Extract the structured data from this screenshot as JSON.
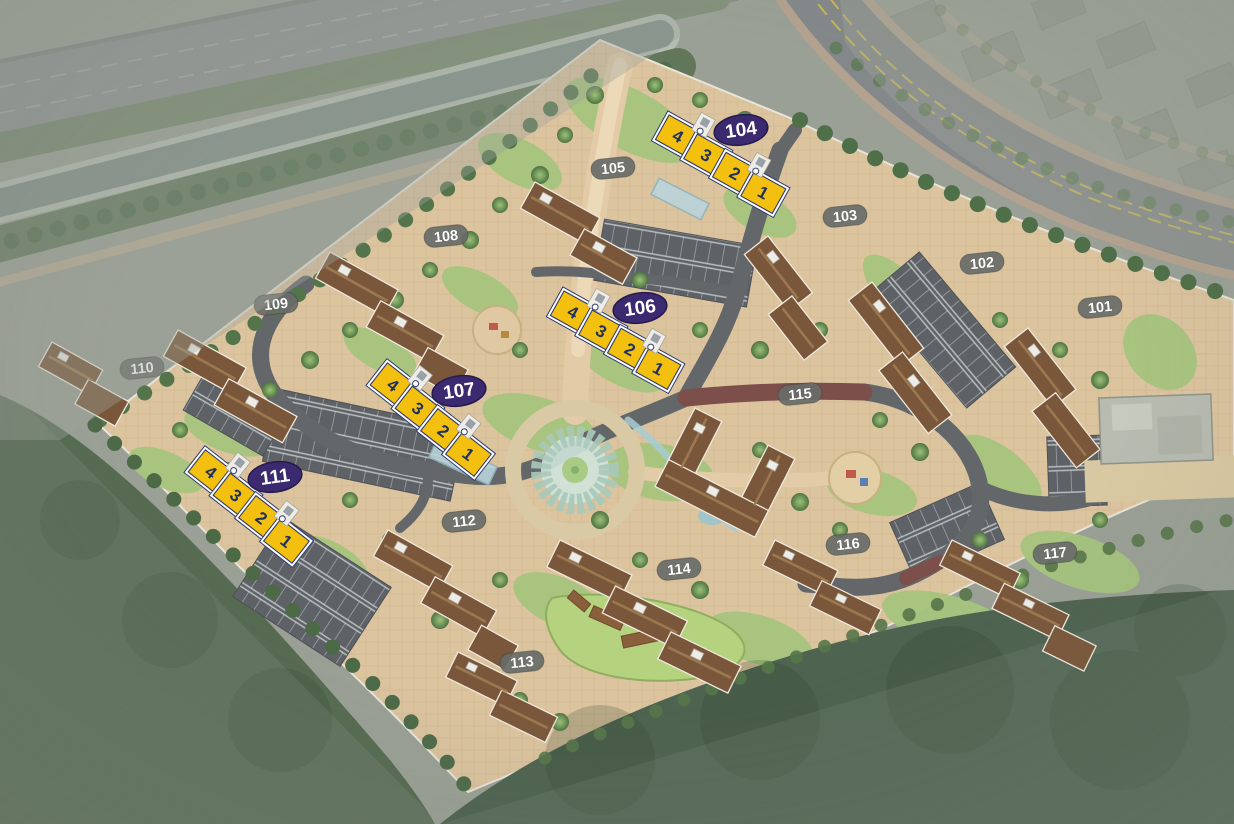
{
  "map": {
    "kind": "apartment-complex-site-plan",
    "unit_numbers": [
      "4",
      "3",
      "2",
      "1"
    ],
    "highlighted_building_ids": [
      "104",
      "106",
      "107",
      "111"
    ],
    "building_labels": {
      "101": "101",
      "102": "102",
      "103": "103",
      "104": "104",
      "105": "105",
      "106": "106",
      "107": "107",
      "108": "108",
      "109": "109",
      "110": "110",
      "111": "111",
      "112": "112",
      "113": "113",
      "114": "114",
      "115": "115",
      "116": "116",
      "117": "117"
    },
    "colors": {
      "highlight_yellow": "#F3C00F",
      "badge_purple": "#3B2A6F",
      "label_gray_pill": "#686B68",
      "label_text": "#FFFFFF",
      "unit_number_navy": "#20305F",
      "roof_brown": "#7A573B",
      "road_gray": "#63676A",
      "accent_road_maroon": "#7D4F4A",
      "paving_tan": "#DCC49F",
      "lawn_green": "#A6C57E",
      "forest_green": "#4E6350",
      "canal_gray_green": "#7F8D85"
    }
  }
}
